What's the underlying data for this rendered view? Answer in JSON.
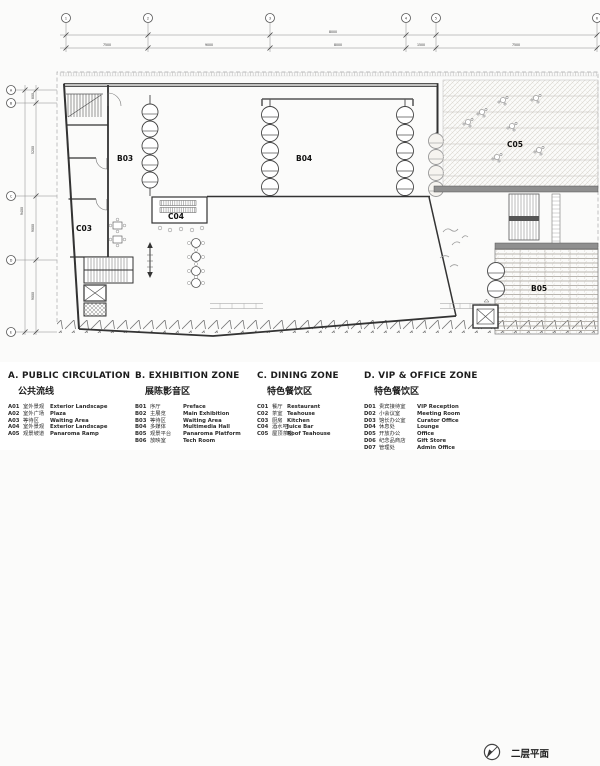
{
  "plan": {
    "title": "二层平面",
    "rooms": {
      "b03": "B03",
      "b04": "B04",
      "b05": "B05",
      "c03": "C03",
      "c04": "C04",
      "c05": "C05"
    },
    "dims_top": {
      "overall": "8000",
      "segments": [
        "7500",
        "9000",
        "8000",
        "1500",
        "7500"
      ]
    },
    "dims_left": {
      "overall": "9400",
      "segments": [
        "800",
        "5200",
        "9000",
        "9000"
      ]
    },
    "grid_top": [
      "1",
      "2",
      "3",
      "4",
      "5",
      "6"
    ],
    "grid_left": [
      "A",
      "B",
      "C",
      "D",
      "E"
    ]
  },
  "legend": {
    "plan_label": "二层平面",
    "sections": [
      {
        "id": "A",
        "title": "A. PUBLIC CIRCULATION",
        "subtitle": "公共流线",
        "items": [
          {
            "code": "A01",
            "cn": "室外景观",
            "en": "Exterior Landscape"
          },
          {
            "code": "A02",
            "cn": "室外广场",
            "en": "Plaza"
          },
          {
            "code": "A03",
            "cn": "等待区",
            "en": "Waiting Area"
          },
          {
            "code": "A04",
            "cn": "室外景观",
            "en": "Exterior Landscape"
          },
          {
            "code": "A05",
            "cn": "观景坡道",
            "en": "Panaroma Ramp"
          }
        ]
      },
      {
        "id": "B",
        "title": "B. EXHIBITION ZONE",
        "subtitle": "展陈影音区",
        "items": [
          {
            "code": "B01",
            "cn": "序厅",
            "en": "Preface"
          },
          {
            "code": "B02",
            "cn": "主展览",
            "en": "Main Exhibition"
          },
          {
            "code": "B03",
            "cn": "等待区",
            "en": "Waiting Area"
          },
          {
            "code": "B04",
            "cn": "多媒体",
            "en": "Multimedia Hall"
          },
          {
            "code": "B05",
            "cn": "观景平台",
            "en": "Panaroma Platform"
          },
          {
            "code": "B06",
            "cn": "放映室",
            "en": "Tech Room"
          }
        ]
      },
      {
        "id": "C",
        "title": "C. DINING ZONE",
        "subtitle": "特色餐饮区",
        "items": [
          {
            "code": "C01",
            "cn": "餐厅",
            "en": "Restaurant"
          },
          {
            "code": "C02",
            "cn": "茶室",
            "en": "Teahouse"
          },
          {
            "code": "C03",
            "cn": "厨房",
            "en": "Kitchen"
          },
          {
            "code": "C04",
            "cn": "酒水吧",
            "en": "Juice Bar"
          },
          {
            "code": "C05",
            "cn": "屋顶茶座",
            "en": "Roof Teahouse"
          }
        ]
      },
      {
        "id": "D",
        "title": "D. VIP & OFFICE ZONE",
        "subtitle": "特色餐饮区",
        "items": [
          {
            "code": "D01",
            "cn": "贵宾接待室",
            "en": "VIP Reception"
          },
          {
            "code": "D02",
            "cn": "小会议室",
            "en": "Meeting Room"
          },
          {
            "code": "D03",
            "cn": "馆长办公室",
            "en": "Curator Office"
          },
          {
            "code": "D04",
            "cn": "休息处",
            "en": "Lounge"
          },
          {
            "code": "D05",
            "cn": "开放办公",
            "en": "Office"
          },
          {
            "code": "D06",
            "cn": "纪念品商店",
            "en": "Gift Store"
          },
          {
            "code": "D07",
            "cn": "管理处",
            "en": "Admin Office"
          }
        ]
      }
    ]
  },
  "colors": {
    "line": "#3a3a3a",
    "light_line": "#999999",
    "band": "#8f8f8f",
    "hatch": "#c9c4bc",
    "paper": "#ffffff"
  }
}
